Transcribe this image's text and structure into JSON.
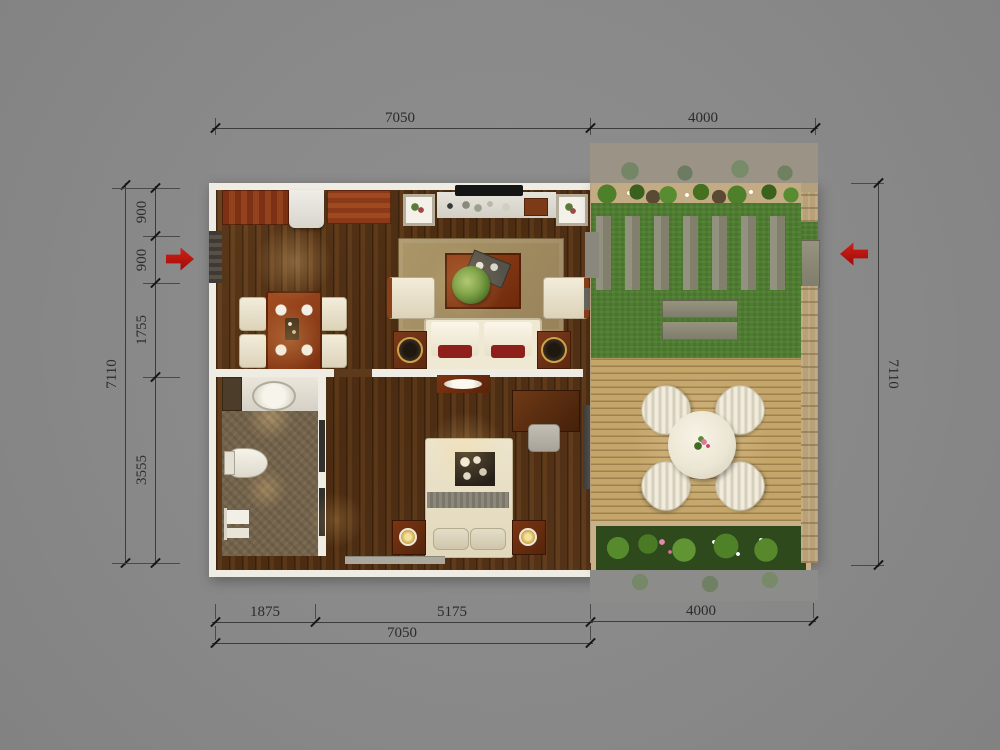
{
  "plan": {
    "title": "two-room-apartment-floor-plan-with-garden",
    "dimensions": {
      "top_house_width": "7050",
      "top_garden_width": "4000",
      "left_total_height": "7110",
      "left_segments": [
        "900",
        "900",
        "1755",
        "3555"
      ],
      "right_total_height": "7110",
      "bottom_segments": [
        "1875",
        "5175"
      ],
      "bottom_house_width": "7050",
      "bottom_garden_width": "4000"
    },
    "icons": {
      "entrance_left": "red-arrow-right",
      "entrance_right": "red-arrow-left"
    },
    "colors": {
      "background": "#8b8b8b",
      "wall": "#efece3",
      "wood_floor": "#5a3a1d",
      "lawn_green": "#4e7c30",
      "deck_tan": "#c4a66b",
      "stone_wall": "#b9a177",
      "entrance_arrow_red": "#c01010",
      "dimension_text": "#2b2b2b"
    }
  }
}
